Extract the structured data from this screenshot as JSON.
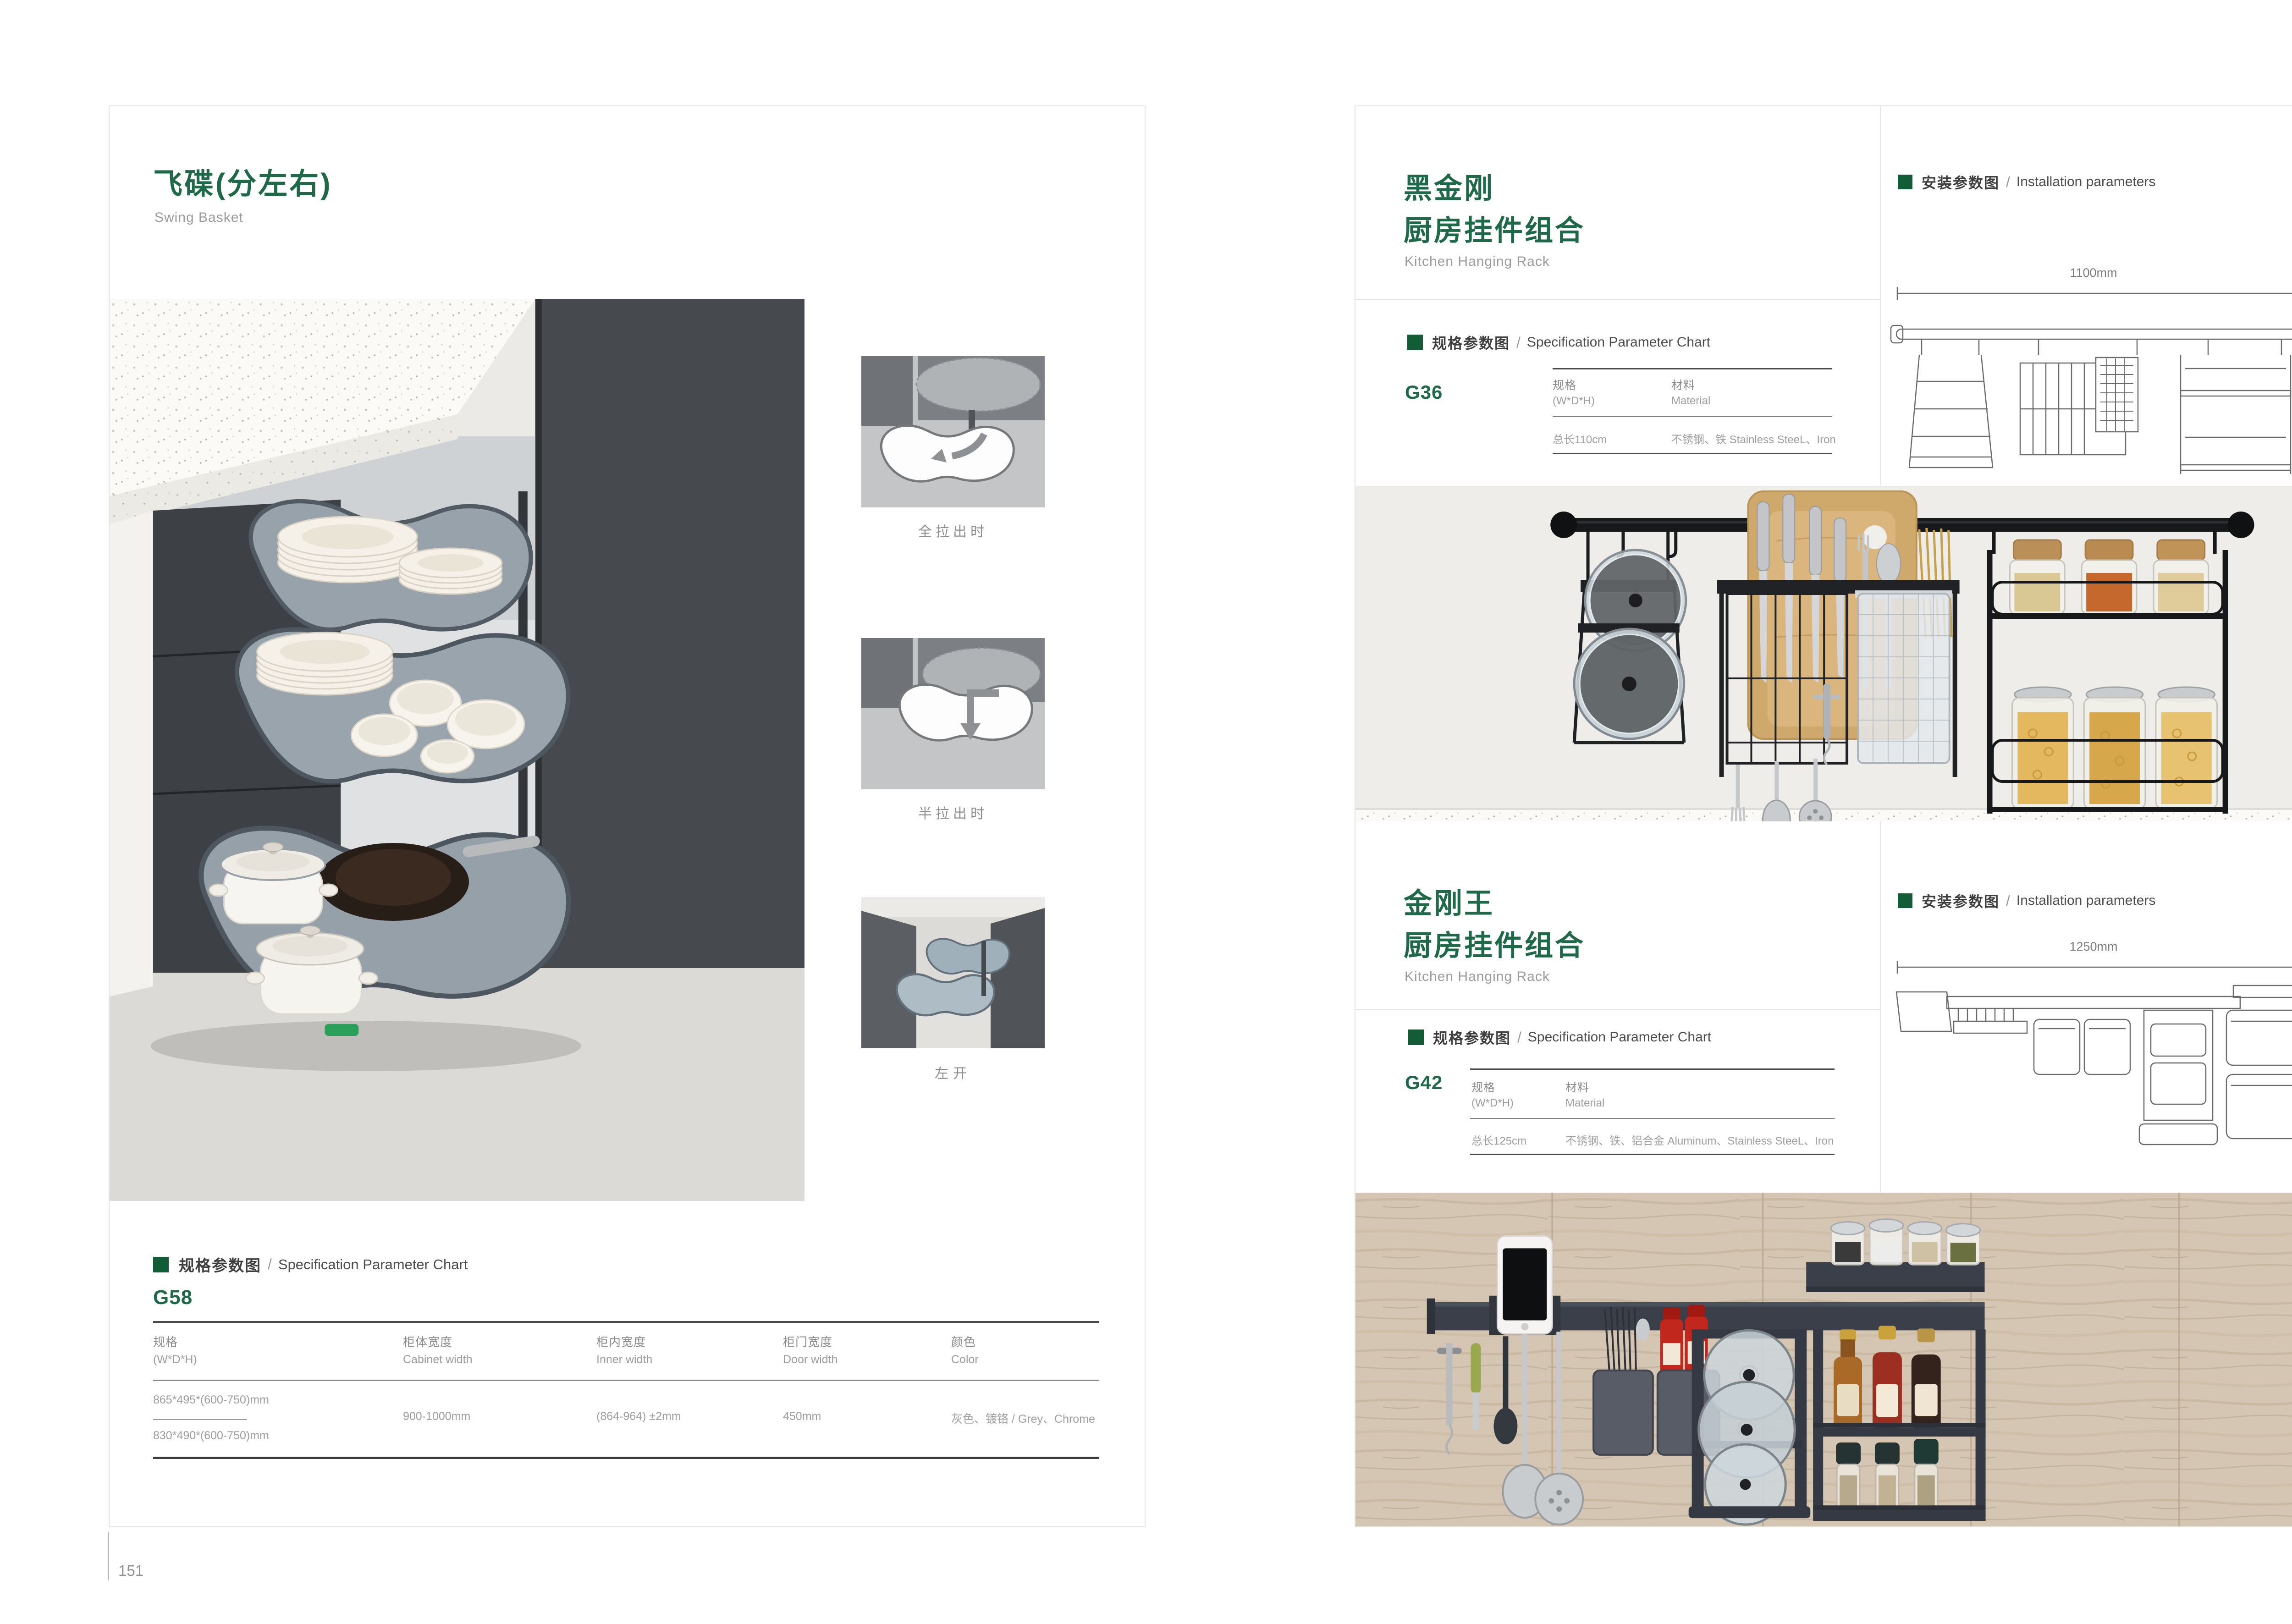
{
  "sep": "/",
  "accent_green": "#135c38",
  "title_green": "#1e6a48",
  "page_left": {
    "page_number": "151",
    "title_zh": "飞碟(分左右)",
    "title_en": "Swing Basket",
    "thumbnails": [
      {
        "caption": "全拉出时"
      },
      {
        "caption": "半拉出时"
      },
      {
        "caption": "左开"
      }
    ],
    "spec": {
      "heading_zh": "规格参数图",
      "heading_en": "Specification Parameter Chart",
      "code": "G58",
      "columns": [
        {
          "zh": "规格",
          "en": "(W*D*H)"
        },
        {
          "zh": "柜体宽度",
          "en": "Cabinet width"
        },
        {
          "zh": "柜内宽度",
          "en": "Inner width"
        },
        {
          "zh": "柜门宽度",
          "en": "Door width"
        },
        {
          "zh": "颜色",
          "en": "Color"
        }
      ],
      "row": {
        "size_a": "865*495*(600-750)mm",
        "size_b": "830*490*(600-750)mm",
        "cabinet_width": "900-1000mm",
        "inner_width": "(864-964) ±2mm",
        "door_width": "450mm",
        "color": "灰色、镀铬 / Grey、Chrome"
      }
    }
  },
  "page_right": {
    "page_number": "152",
    "section_top": {
      "title_zh_1": "黑金刚",
      "title_zh_2": "厨房挂件组合",
      "title_en": "Kitchen Hanging Rack",
      "spec_heading_zh": "规格参数图",
      "spec_heading_en": "Specification Parameter Chart",
      "code": "G36",
      "col_spec_zh": "规格",
      "col_spec_en": "(W*D*H)",
      "col_mat_zh": "材料",
      "col_mat_en": "Material",
      "value_spec": "总长110cm",
      "value_mat": "不锈钢、铁  Stainless SteeL、Iron",
      "install_heading_zh": "安装参数图",
      "install_heading_en": "Installation parameters",
      "dim_width": "1100mm",
      "dim_height": "420mm"
    },
    "section_bottom": {
      "title_zh_1": "金刚王",
      "title_zh_2": "厨房挂件组合",
      "title_en": "Kitchen Hanging Rack",
      "spec_heading_zh": "规格参数图",
      "spec_heading_en": "Specification Parameter Chart",
      "code": "G42",
      "col_spec_zh": "规格",
      "col_spec_en": "(W*D*H)",
      "col_mat_zh": "材料",
      "col_mat_en": "Material",
      "value_spec": "总长125cm",
      "value_mat": "不锈钢、铁、铝合金  Aluminum、Stainless SteeL、Iron",
      "install_heading_zh": "安装参数图",
      "install_heading_en": "Installation parameters",
      "dim_width": "1250mm",
      "dim_height": "430mm"
    }
  }
}
